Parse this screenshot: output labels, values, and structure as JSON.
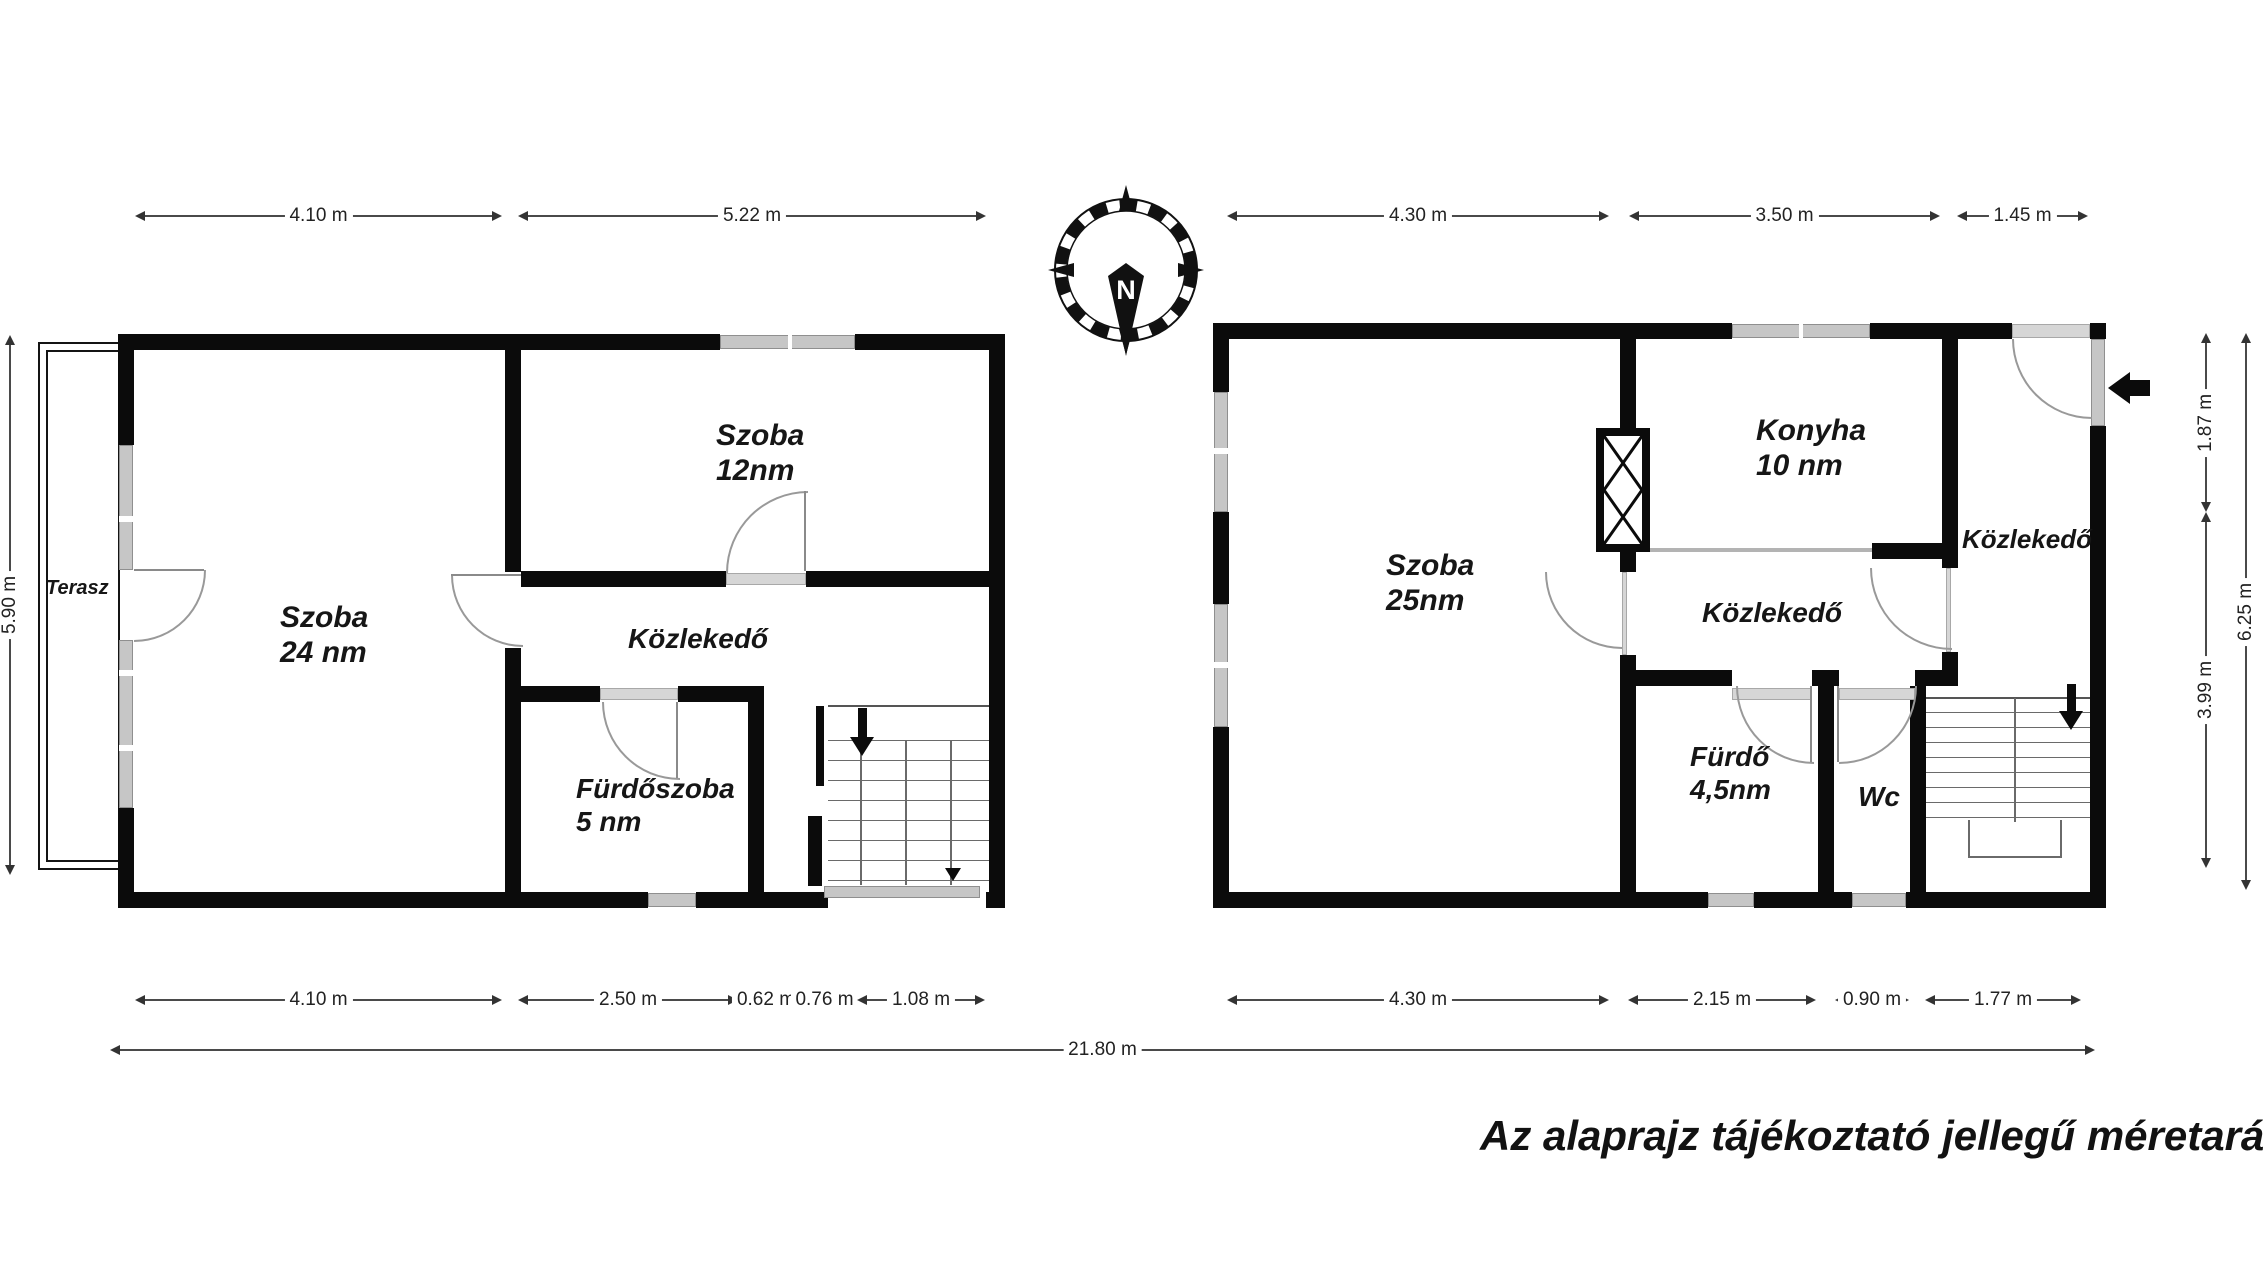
{
  "floorplan": {
    "disclaimer": "Az alaprajz tájékoztató jellegű méretarányos!",
    "compass": {
      "north_label": "N"
    },
    "left_plan": {
      "terasz": {
        "name": "Terasz"
      },
      "szoba24": {
        "name": "Szoba",
        "area": "24 nm"
      },
      "szoba12": {
        "name": "Szoba",
        "area": "12nm"
      },
      "kozlekedo": {
        "name": "Közlekedő"
      },
      "furdoszoba": {
        "name": "Fürdőszoba",
        "area": "5 nm"
      }
    },
    "right_plan": {
      "szoba25": {
        "name": "Szoba",
        "area": "25nm"
      },
      "konyha": {
        "name": "Konyha",
        "area": "10 nm"
      },
      "kozlekedo_middle": {
        "name": "Közlekedő"
      },
      "kozlekedo_right": {
        "name": "Közlekedő"
      },
      "furdo": {
        "name": "Fürdő",
        "area": "4,5nm"
      },
      "wc": {
        "name": "Wc"
      }
    },
    "dimensions": {
      "top": {
        "y": 216,
        "segments": [
          {
            "label": "4.10 m",
            "x1": 135,
            "x2": 502
          },
          {
            "label": "5.22 m",
            "x1": 518,
            "x2": 986
          },
          {
            "label": "4.30 m",
            "x1": 1227,
            "x2": 1609
          },
          {
            "label": "3.50 m",
            "x1": 1629,
            "x2": 1940
          },
          {
            "label": "1.45 m",
            "x1": 1957,
            "x2": 2088
          }
        ]
      },
      "bottom": {
        "y": 1000,
        "segments": [
          {
            "label": "4.10 m",
            "x1": 135,
            "x2": 502
          },
          {
            "label": "2.50 m",
            "x1": 518,
            "x2": 738
          },
          {
            "label": "0.62 m",
            "x1": 740,
            "x2": 792
          },
          {
            "label": "0.76 m",
            "x1": 797,
            "x2": 852
          },
          {
            "label": "1.08 m",
            "x1": 857,
            "x2": 985
          },
          {
            "label": "4.30 m",
            "x1": 1227,
            "x2": 1609
          },
          {
            "label": "2.15 m",
            "x1": 1628,
            "x2": 1816
          },
          {
            "label": "0.90 m",
            "x1": 1835,
            "x2": 1909
          },
          {
            "label": "1.77 m",
            "x1": 1925,
            "x2": 2081
          }
        ]
      },
      "total": {
        "label": "21.80 m",
        "x1": 110,
        "x2": 2095,
        "y": 1050
      },
      "vertical": [
        {
          "label": "5.90 m",
          "x": 10,
          "y1": 335,
          "y2": 875
        },
        {
          "label": "1.87 m",
          "x": 2206,
          "y1": 333,
          "y2": 512
        },
        {
          "label": "3.99 m",
          "x": 2206,
          "y1": 512,
          "y2": 868
        },
        {
          "label": "6.25 m",
          "x": 2246,
          "y1": 333,
          "y2": 890
        }
      ]
    }
  }
}
